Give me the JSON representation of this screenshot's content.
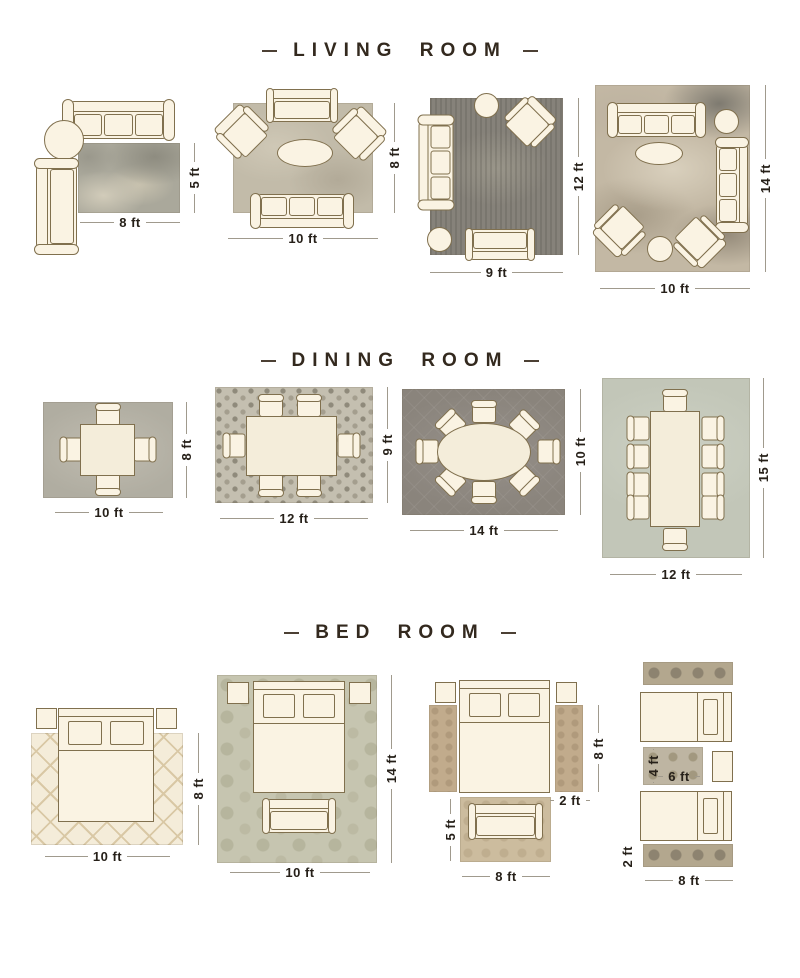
{
  "page": {
    "background": "#ffffff"
  },
  "palette": {
    "title_text": "#33291e",
    "dimension_text": "#262019",
    "dimension_line": "#a09a8d",
    "furniture_fill": "#faf3e3",
    "furniture_outline": "#80704e"
  },
  "sections": [
    {
      "title": "LIVING ROOM",
      "layouts": [
        {
          "w": "8 ft",
          "h": "5 ft"
        },
        {
          "w": "10 ft",
          "h": "8 ft"
        },
        {
          "w": "9 ft",
          "h": "12 ft"
        },
        {
          "w": "10 ft",
          "h": "14 ft"
        }
      ]
    },
    {
      "title": "DINING ROOM",
      "layouts": [
        {
          "w": "10 ft",
          "h": "8 ft"
        },
        {
          "w": "12 ft",
          "h": "9 ft"
        },
        {
          "w": "14 ft",
          "h": "10 ft"
        },
        {
          "w": "12 ft",
          "h": "15 ft"
        }
      ]
    },
    {
      "title": "BED ROOM",
      "layouts": [
        {
          "w": "10 ft",
          "h": "8 ft"
        },
        {
          "w": "10 ft",
          "h": "14 ft"
        },
        {
          "w": "8 ft",
          "h": "5 ft",
          "side_runner_h": "8 ft",
          "side_runner_w": "2 ft"
        },
        {
          "w": "8 ft",
          "runner_h": "2 ft",
          "accent_w": "6 ft",
          "accent_h": "4 ft"
        }
      ]
    }
  ]
}
